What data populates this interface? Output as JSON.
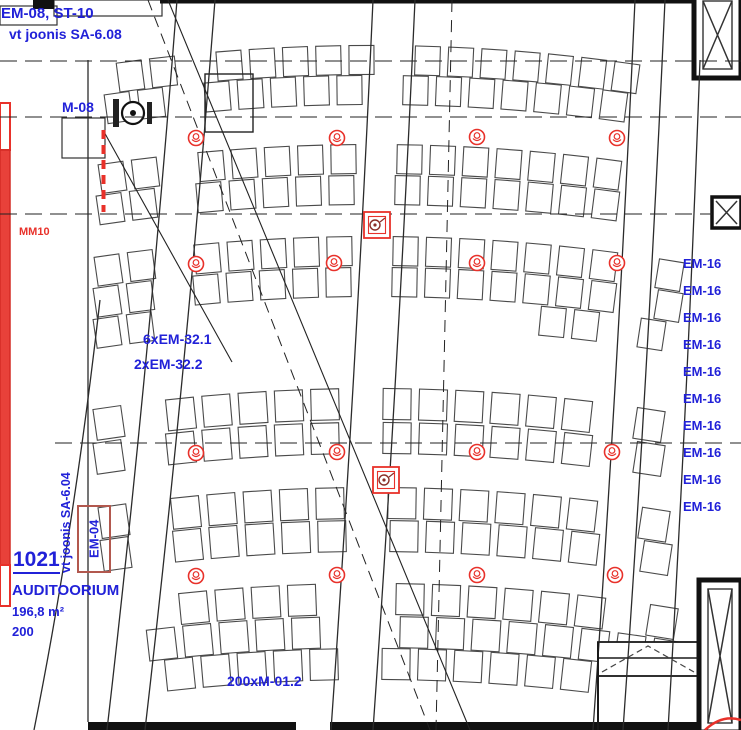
{
  "title": "Auditorium 1021 electrical ceiling plan",
  "labels": {
    "ref_top": "EM-08, ST-10",
    "ref_top_drawing": "vt joonis SA-6.08",
    "device_m08": "M-08",
    "mm10": "MM10",
    "em32_line1": "6xEM-32.1",
    "em32_line2": "2xEM-32.2",
    "em04": "EM-04",
    "ref_side_drawing": "vt joonis SA-6.04",
    "room_number": "1021",
    "room_name": "AUDITOORIUM",
    "room_area": "196,8 m²",
    "room_capacity": "200",
    "seats_label": "200xM-01.2"
  },
  "em16_labels": [
    "EM-16",
    "EM-16",
    "EM-16",
    "EM-16",
    "EM-16",
    "EM-16",
    "EM-16",
    "EM-16",
    "EM-16",
    "EM-16"
  ],
  "em16_layout": {
    "top_first": 257,
    "spacing": 27
  },
  "colors": {
    "label_blue": "#2121d8",
    "annotation_red": "#e8312a",
    "em04_box_red": "#b2584e",
    "line_dark": "#1a1a1a"
  },
  "drawing": {
    "canvas": {
      "w": 741,
      "h": 730
    },
    "arc": {
      "cx": 372,
      "r": 1830
    },
    "seat_stroke": "#4a4a4a",
    "seat_blocks": [
      {
        "seatW": 25,
        "seatH": 29,
        "pitch": 33,
        "rows": [
          {
            "y": 60,
            "x0": 118,
            "x1": 660
          },
          {
            "y": 90,
            "x0": 106,
            "x1": 668
          },
          {
            "y": 159,
            "x0": 100,
            "x1": 676
          },
          {
            "y": 190,
            "x0": 98,
            "x1": 680
          },
          {
            "y": 251,
            "x0": 96,
            "x1": 684
          },
          {
            "y": 282,
            "x0": 95,
            "x1": 688
          },
          {
            "y": 313,
            "segments": [
              [
                95,
                175
              ],
              [
                540,
                690
              ]
            ]
          }
        ]
      },
      {
        "seatW": 28,
        "seatH": 31,
        "pitch": 36,
        "rows": [
          {
            "y": 404,
            "x0": 95,
            "x1": 690
          },
          {
            "y": 438,
            "x0": 95,
            "x1": 690
          },
          {
            "y": 503,
            "x0": 100,
            "x1": 688
          },
          {
            "y": 536,
            "x0": 102,
            "x1": 688
          },
          {
            "y": 599,
            "x0": 108,
            "x1": 684
          },
          {
            "y": 632,
            "x0": 112,
            "x1": 680
          },
          {
            "y": 664,
            "x0": 130,
            "x1": 658
          }
        ]
      }
    ],
    "aisles": [
      {
        "c0": 196,
        "slope": -0.095,
        "w": 40
      },
      {
        "c0": 394,
        "slope": -0.058,
        "w": 44
      },
      {
        "c0": 650,
        "slope": -0.058,
        "w": 32
      }
    ],
    "lines": [
      {
        "d": "M 0,61 L 741,61",
        "w": 1.1,
        "dash": "17 8",
        "c": "#222222"
      },
      {
        "d": "M 0,117 L 741,117",
        "w": 1.1,
        "dash": "17 8",
        "c": "#222222"
      },
      {
        "d": "M 0,214 L 712,214",
        "w": 1.1,
        "dash": "17 8",
        "c": "#222222"
      },
      {
        "d": "M 55,443 L 741,443",
        "w": 1.1,
        "dash": "17 8",
        "c": "#222222"
      },
      {
        "d": "M 168,0 L 470,730",
        "w": 1.1,
        "c": "#222222"
      },
      {
        "d": "M 103,130 L 232,362",
        "w": 1.1,
        "c": "#222222"
      },
      {
        "d": "M 148,0 L 430,730",
        "w": 1.0,
        "dash": "11 7",
        "c": "#222222"
      },
      {
        "d": "M 452,0 Q 444,370 436,730",
        "w": 1.0,
        "dash": "12 8",
        "c": "#222222"
      },
      {
        "d": "M 177,0 Q 148,375 107,730",
        "w": 1.3,
        "c": "#2b2b2b"
      },
      {
        "d": "M 215,0 Q 186,375 145,730",
        "w": 1.3,
        "c": "#2b2b2b"
      },
      {
        "d": "M 373,0 Q 356,375 331,730",
        "w": 1.3,
        "c": "#2b2b2b"
      },
      {
        "d": "M 415,0 Q 398,375 373,730",
        "w": 1.3,
        "c": "#2b2b2b"
      },
      {
        "d": "M 635,0 Q 618,375 593,730",
        "w": 1.3,
        "c": "#2b2b2b"
      },
      {
        "d": "M 665,0 Q 648,375 623,730",
        "w": 1.3,
        "c": "#2b2b2b"
      },
      {
        "d": "M 700,60 Q 688,390 668,730",
        "w": 1.3,
        "c": "#2b2b2b"
      },
      {
        "d": "M 100,300 Q 74,530 34,730",
        "w": 1.3,
        "c": "#2b2b2b"
      },
      {
        "d": "M 88,60 L 88,722",
        "w": 1.3,
        "c": "#2b2b2b"
      },
      {
        "d": "M 598,658 L 698,658",
        "w": 1.4,
        "c": "#1a1a1a"
      },
      {
        "d": "M 598,642 L 598,730",
        "w": 2,
        "c": "#1a1a1a"
      },
      {
        "d": "M 602,672 L 648,646 L 694,672",
        "w": 1.2,
        "dash": "6 4",
        "c": "#444444"
      },
      {
        "d": "M 705,730 Q 722,714 741,720",
        "w": 2.5,
        "c": "#e8312a"
      },
      {
        "d": "M 103.5,130 L 103.5,212",
        "w": 4,
        "dash": "9 6",
        "c": "#e8312a"
      }
    ],
    "rects": [
      {
        "x": 0,
        "y": 6,
        "w": 57,
        "h": 19,
        "sw": 1.2,
        "c": "#333333",
        "f": "#ffffff"
      },
      {
        "x": 54,
        "y": 0,
        "w": 108,
        "h": 16,
        "sw": 1.2,
        "c": "#333333",
        "f": "none"
      },
      {
        "x": 33,
        "y": 0,
        "w": 21,
        "h": 9,
        "f": "#111111"
      },
      {
        "x": 160,
        "y": 0,
        "w": 537,
        "h": 3.5,
        "f": "#111111"
      },
      {
        "x": 205,
        "y": 74,
        "w": 48,
        "h": 58,
        "sw": 1.4,
        "c": "#222222",
        "f": "none"
      },
      {
        "x": 62,
        "y": 118,
        "w": 43,
        "h": 40,
        "sw": 1.2,
        "c": "#333333",
        "f": "none"
      },
      {
        "x": 598,
        "y": 642,
        "w": 100,
        "h": 34,
        "sw": 1.8,
        "c": "#1a1a1a",
        "f": "#ffffff"
      },
      {
        "x": 88,
        "y": 722,
        "w": 208,
        "h": 8,
        "f": "#111111"
      },
      {
        "x": 330,
        "y": 722,
        "w": 411,
        "h": 8,
        "f": "#111111"
      },
      {
        "x": 0,
        "y": 103,
        "w": 10,
        "h": 47,
        "sw": 2,
        "c": "#e8312a",
        "f": "#ffffff"
      },
      {
        "x": 0,
        "y": 150,
        "w": 10,
        "h": 415,
        "sw": 1.5,
        "c": "#d42b24",
        "f": "#e8413a"
      },
      {
        "x": 0,
        "y": 565,
        "w": 10,
        "h": 41,
        "sw": 2,
        "c": "#e8312a",
        "f": "#ffffff"
      }
    ],
    "xboxes": [
      {
        "x": 694,
        "y": -8,
        "w": 47,
        "h": 86,
        "bw": 5,
        "inset": 9
      },
      {
        "x": 712,
        "y": 197,
        "w": 29,
        "h": 31,
        "bw": 3.5,
        "inset": 4
      },
      {
        "x": 699,
        "y": 580,
        "w": 42,
        "h": 152,
        "bw": 5,
        "inset": 9
      }
    ],
    "m08_symbol": {
      "cx": 133,
      "cy": 113
    },
    "detectors": [
      [
        196,
        138
      ],
      [
        337,
        138
      ],
      [
        477,
        137
      ],
      [
        617,
        138
      ],
      [
        196,
        264
      ],
      [
        334,
        263
      ],
      [
        477,
        263
      ],
      [
        617,
        263
      ],
      [
        196,
        453
      ],
      [
        337,
        452
      ],
      [
        477,
        452
      ],
      [
        612,
        452
      ],
      [
        196,
        576
      ],
      [
        337,
        575
      ],
      [
        477,
        575
      ],
      [
        615,
        575
      ]
    ],
    "junction_boxes": [
      [
        377,
        225
      ],
      [
        386,
        480
      ]
    ]
  }
}
